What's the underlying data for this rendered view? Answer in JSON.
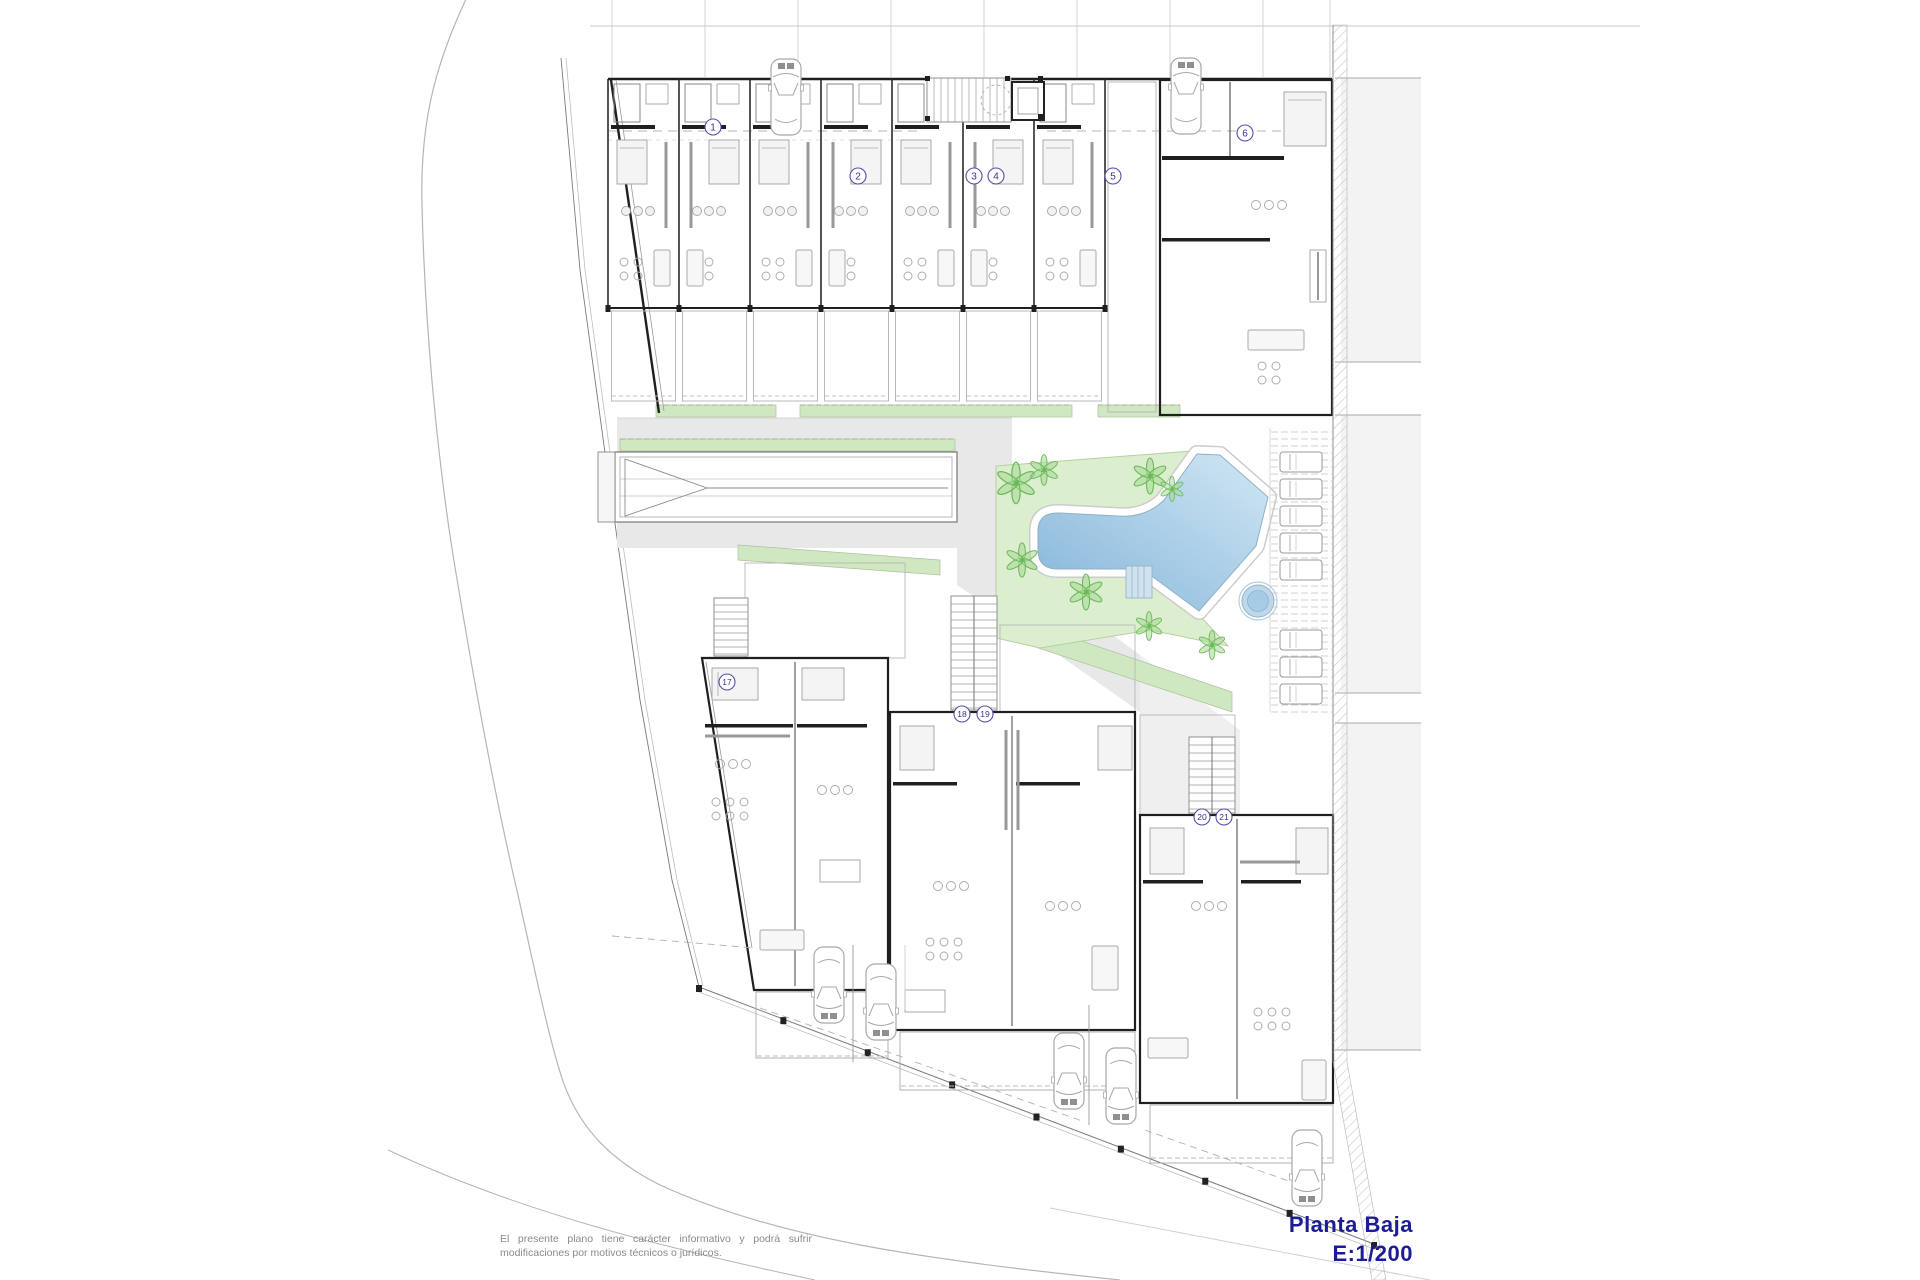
{
  "drawing": {
    "title": "Planta Baja",
    "scale": "E:1/200",
    "disclaimer_line1": "El presente plano tiene carácter informativo y podrá sufrir",
    "disclaimer_line2": "modificaciones por motivos técnicos o jurídicos."
  },
  "colors": {
    "title": "#1c1c96",
    "disclaimer": "#8a8a8a",
    "marker_stroke": "#5050aa",
    "marker_text": "#34349c",
    "wall": "#1f1f1f",
    "thin_wall": "#555555",
    "furniture": "#a8a8a8",
    "garden": "#dbeecd",
    "garden_border": "#b7cfa4",
    "green_strip": "#cfe8c2",
    "palm": "#6cb85c",
    "palm_fill": "#a5d894",
    "pool_dark": "#84b5d9",
    "pool_light": "#d0e7f4",
    "pool_border": "#8fb0c6",
    "spa_outer": "#bcd9ec",
    "spa_inner": "#a6cbe4",
    "path_gray": "#e8e8e8",
    "neighbor_gray": "#f3f3f3",
    "hatch": "#c6c6c6",
    "street": "#b5b5b5",
    "fence": "#7a7a7a",
    "deck_line": "#c4c4c4",
    "stair": "#8f8f8f",
    "car": "#a8a8a8",
    "car_glass": "#8f8f8f"
  },
  "unit_markers": [
    {
      "label": "1",
      "x": 713,
      "y": 127
    },
    {
      "label": "2",
      "x": 858,
      "y": 176
    },
    {
      "label": "3",
      "x": 974,
      "y": 176
    },
    {
      "label": "4",
      "x": 996,
      "y": 176
    },
    {
      "label": "5",
      "x": 1113,
      "y": 176
    },
    {
      "label": "6",
      "x": 1245,
      "y": 133
    },
    {
      "label": "17",
      "x": 727,
      "y": 682
    },
    {
      "label": "18",
      "x": 962,
      "y": 714
    },
    {
      "label": "19",
      "x": 985,
      "y": 714
    },
    {
      "label": "20",
      "x": 1202,
      "y": 817
    },
    {
      "label": "21",
      "x": 1224,
      "y": 817
    }
  ],
  "cars": [
    {
      "x": 786,
      "y": 97,
      "rot": 0
    },
    {
      "x": 1186,
      "y": 96,
      "rot": 0
    },
    {
      "x": 829,
      "y": 985,
      "rot": 180
    },
    {
      "x": 881,
      "y": 1002,
      "rot": 180
    },
    {
      "x": 1069,
      "y": 1071,
      "rot": 180
    },
    {
      "x": 1121,
      "y": 1086,
      "rot": 180
    },
    {
      "x": 1307,
      "y": 1168,
      "rot": 180
    }
  ],
  "palms": [
    {
      "x": 1016,
      "y": 483,
      "s": 1.15
    },
    {
      "x": 1044,
      "y": 470,
      "s": 0.85
    },
    {
      "x": 1150,
      "y": 476,
      "s": 1.0
    },
    {
      "x": 1172,
      "y": 489,
      "s": 0.7
    },
    {
      "x": 1022,
      "y": 560,
      "s": 0.95
    },
    {
      "x": 1086,
      "y": 592,
      "s": 1.0
    },
    {
      "x": 1149,
      "y": 626,
      "s": 0.8
    },
    {
      "x": 1212,
      "y": 645,
      "s": 0.8
    }
  ],
  "loungers_y": [
    452,
    479,
    506,
    533,
    560,
    630,
    657,
    684
  ]
}
